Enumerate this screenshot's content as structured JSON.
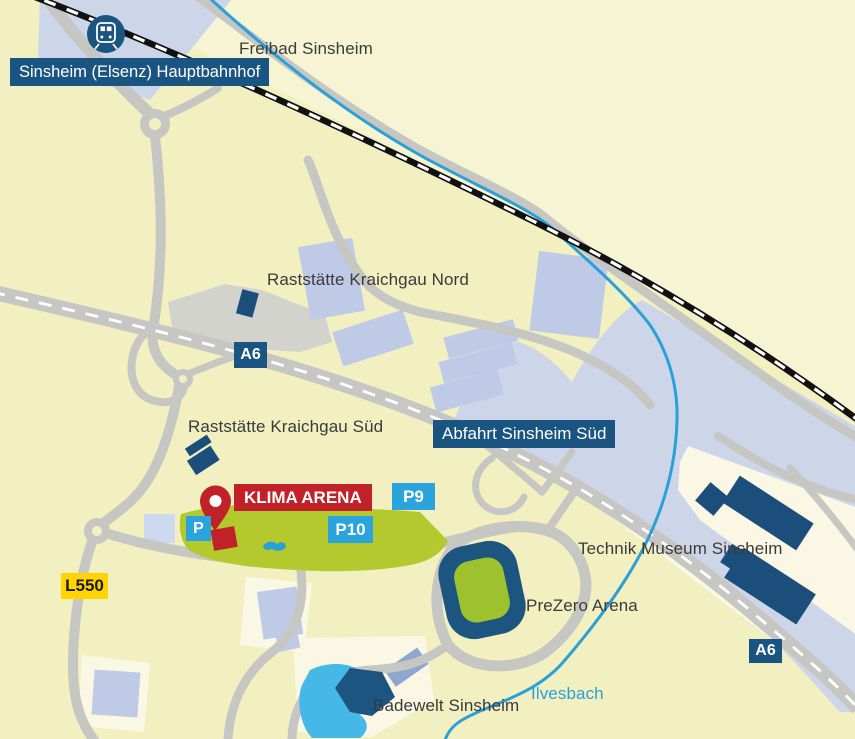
{
  "map_type": "static-location-map",
  "labels": {
    "freibad": "Freibad Sinsheim",
    "raststaette_nord": "Raststätte Kraichgau Nord",
    "raststaette_sued": "Raststätte Kraichgau Süd",
    "technik_museum": "Technik Museum Sinsheim",
    "prezero_arena": "PreZero Arena",
    "badewelt": "Badewelt Sinsheim",
    "ilvesbach": "Ilvesbach"
  },
  "badges": {
    "hauptbahnhof": "Sinsheim (Elsenz) Hauptbahnhof",
    "abfahrt": "Abfahrt Sinsheim Süd",
    "klima_arena": "KLIMA ARENA",
    "a6_top": "A6",
    "a6_bottom": "A6",
    "p9": "P9",
    "p10": "P10",
    "parking": "P",
    "l550": "L550"
  },
  "icons": {
    "train_station": "train-station-icon",
    "location_pin": "location-pin-icon"
  },
  "colors": {
    "background": "#f2efc1",
    "background_light": "#f7f4d4",
    "plot_cream": "#faf8e4",
    "road_gray": "#c6c6c3",
    "rest_area_gray": "#d3d3cd",
    "zone_blue_gray": "#cdd6e8",
    "building_light_blue": "#bfcbe6",
    "building_medium_blue": "#8da7cf",
    "building_dark_blue": "#1b4e7a",
    "navy_badge": "#1a5480",
    "parking_blue": "#29a4dd",
    "arena_green": "#b4c92e",
    "field_green": "#9dc22d",
    "klima_red": "#c1222a",
    "l550_yellow": "#ffd400",
    "river_blue": "#2aa0d8",
    "pool_blue": "#45b8e8",
    "railway_black": "#111111"
  }
}
